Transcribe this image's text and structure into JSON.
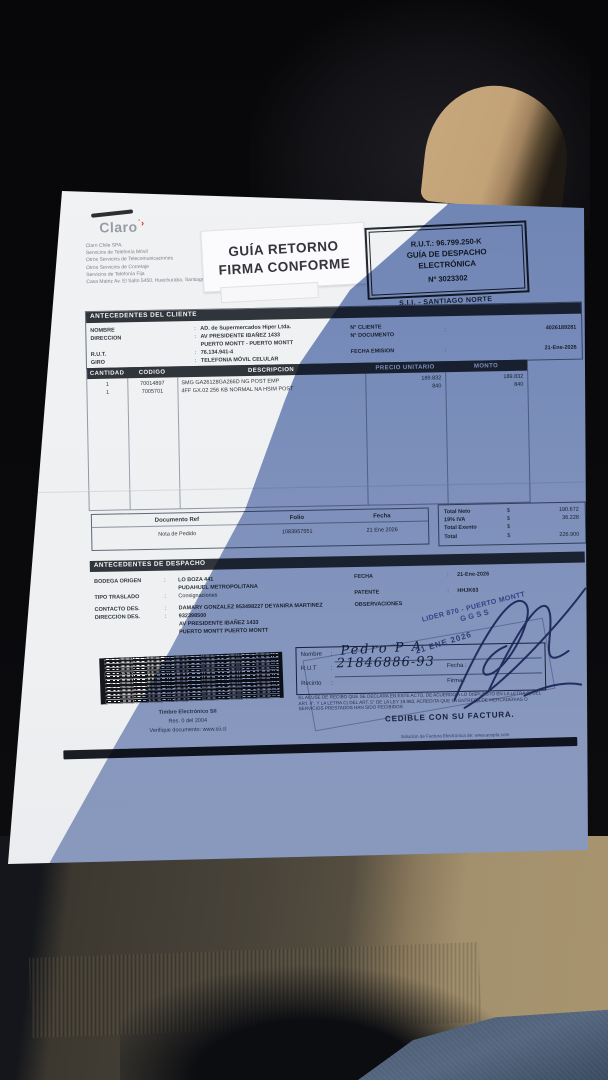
{
  "colors": {
    "claro_red": "#d52b1e",
    "paper_white": "#eff1f4",
    "shadow_blue": "#7d92c2",
    "stamp_ink": "#3b54a0",
    "pen_ink": "#1b2c66",
    "seat_beige": "#c2a276",
    "sweater_brown": "#a3906d"
  },
  "document": {
    "logo_text": "Claro",
    "company_lines": [
      "Claro Chile SPA.",
      "Servicios de Telefonía Móvil",
      "Otros Servicios de Telecomunicaciones",
      "Otros Servicios de Corretaje",
      "Servicios de Telefonía Fija",
      "Casa Matriz Av. El Salto 5450, Huechuraba, Santiago"
    ],
    "return_stamp": {
      "line1": "GUÍA RETORNO",
      "line2": "FIRMA CONFORME"
    },
    "rut_box": {
      "rut": "R.U.T.: 96.799.250-K",
      "doc_type_1": "GUÍA DE DESPACHO",
      "doc_type_2": "ELECTRÓNICA",
      "number": "Nº 3023302"
    },
    "sii_office": "S.I.I. - SANTIAGO NORTE",
    "client": {
      "title": "ANTECEDENTES DEL CLIENTE",
      "labels": {
        "nombre": "NOMBRE",
        "direccion": "DIRECCION",
        "rut": "R.U.T.",
        "giro": "GIRO",
        "n_cliente": "N° CLIENTE",
        "n_documento": "N° DOCUMENTO",
        "fecha_emision": "FECHA EMISION"
      },
      "values": {
        "nombre": "AD. de Supermercados Hiper Ltda.",
        "direccion_1": "AV PRESIDENTE IBAÑEZ 1433",
        "direccion_2": "PUERTO MONTT -  PUERTO MONTT",
        "rut": "76.134.941-4",
        "giro": "TELEFONIA MÓVIL CELULAR",
        "n_documento": "4026189281",
        "fecha_emision": "21-Ene-2026"
      }
    },
    "items": {
      "headers": [
        "CANTIDAD",
        "CODIGO",
        "DESCRIPCION",
        "PRECIO UNITARIO",
        "MONTO"
      ],
      "rows": [
        {
          "qty": "1",
          "code": "70014897",
          "desc": "SMG GA26128GA266D NG POST EMP",
          "unit_price": "189.832",
          "amount": "189.832"
        },
        {
          "qty": "1",
          "code": "7005701",
          "desc": "4FF GX.02 256 KB NORMAL NA HSIM POST",
          "unit_price": "840",
          "amount": "840"
        }
      ]
    },
    "doc_ref": {
      "headers": [
        "Documento Ref",
        "Folio",
        "Fecha"
      ],
      "values": [
        "Nota de Pedido",
        "1083957551",
        "21 Ene 2026"
      ]
    },
    "totals": {
      "rows": [
        {
          "label": "Total Neto",
          "currency": "$",
          "value": "190.672"
        },
        {
          "label": "19% IVA",
          "currency": "$",
          "value": "36.228"
        },
        {
          "label": "Total Exento",
          "currency": "$",
          "value": ""
        },
        {
          "label": "Total",
          "currency": "$",
          "value": "226.900"
        }
      ]
    },
    "dispatch": {
      "title": "ANTECEDENTES DE DESPACHO",
      "labels": {
        "bodega": "BODEGA ORIGEN",
        "tipo": "TIPO TRASLADO",
        "contacto": "CONTACTO DES.",
        "direccion": "DIRECCION DES.",
        "fecha": "FECHA",
        "patente": "PATENTE",
        "observaciones": "OBSERVACIONES"
      },
      "values": {
        "bodega_1": "LO BOZA 441",
        "bodega_2": "PUDAHUEL  METROPOLITANA",
        "tipo": "Consignaciones",
        "contacto": "DAMARY GONZALEZ 953498227 DEYANIRA MARTINEZ",
        "direccion_1": "932398500",
        "direccion_2": "AV PRESIDENTE IBAÑEZ 1433",
        "direccion_3": "PUERTO MONTT  PUERTO MONTT",
        "fecha": "21-Ene-2026",
        "patente": "HHJK63"
      }
    },
    "lider_stamp": {
      "line1": "LIDER 870 - PUERTO MONTT",
      "line2": "GGSS"
    },
    "receipt": {
      "labels": {
        "nombre": "Nombre",
        "rut": "R.U.T",
        "recinto": "Recinto",
        "fecha": "Fecha :",
        "firma": "Firma :"
      },
      "handwritten": {
        "nombre": "Pedro P A",
        "rut": "21846886-93"
      },
      "date_stamp": "21 ENE 2026"
    },
    "legal_text": "EL ACUSE DE RECIBO QUE SE DECLARA EN ESTE ACTO, DE ACUERDO A LO DISPUESTO EN LA LETRA B) DEL ART. 4°, Y LA LETRA C) DEL ART. 5° DE LA LEY 19.983, ACREDITA QUE LA ENTREGA DE MERCADERIAS O SERVICIOS PRESTADOS HAN SIDO RECIBIDOS",
    "cedible": "CEDIBLE CON SU FACTURA.",
    "timbre_lines": [
      "Timbre Electrónico SII",
      "Res. 0 del 2004",
      "Verifique documento: www.sii.cl"
    ],
    "footer_note": "Solución de Factura Electrónica de: www.acepta.com"
  }
}
